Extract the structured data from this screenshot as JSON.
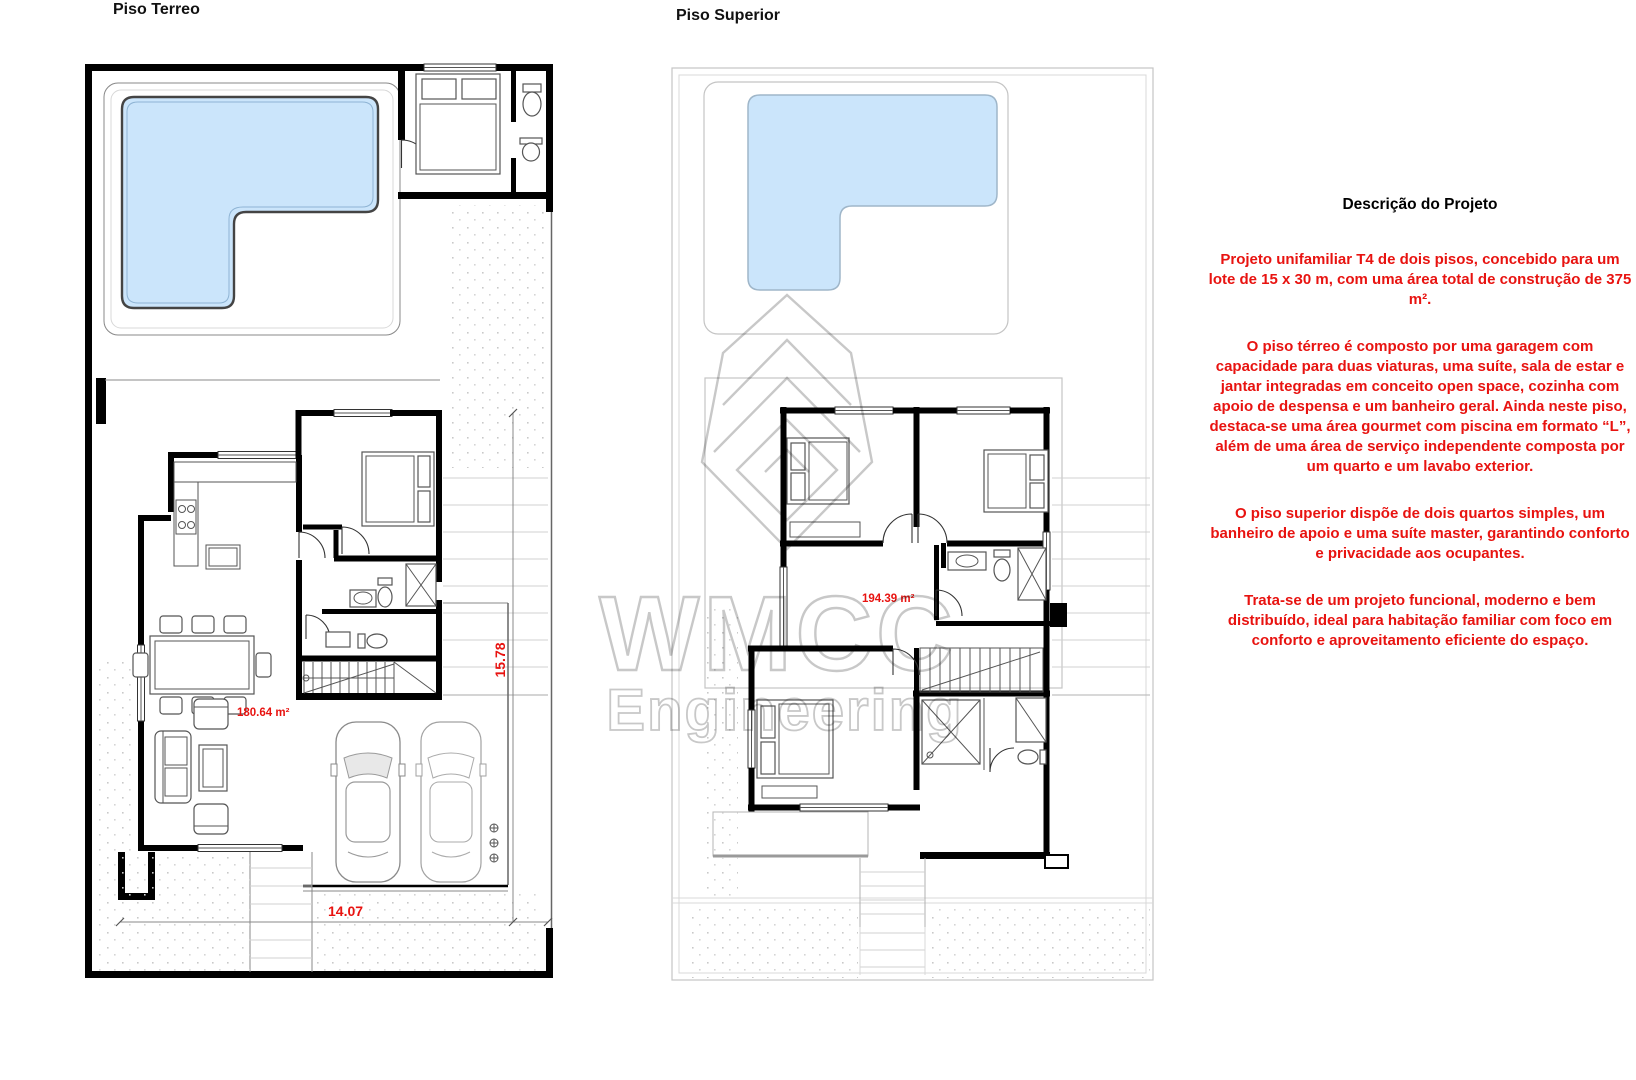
{
  "colors": {
    "red": "#e81310",
    "pool": "#cbe5fb",
    "wall": "#000000",
    "ghost": "#c4c4c4",
    "wm": "#a3a3a3"
  },
  "plans": {
    "ground": {
      "title": "Piso Terreo",
      "area_label": "180.64 m²",
      "dim_width": "14.07",
      "dim_height": "15.78"
    },
    "upper": {
      "title": "Piso Superior",
      "area_label": "194.39 m²"
    }
  },
  "watermark": {
    "line1": "WMCC",
    "line2": "Engineering"
  },
  "description": {
    "heading": "Descrição do Projeto",
    "paragraphs": [
      "Projeto unifamiliar T4 de dois pisos, concebido para um lote de 15 x 30 m, com uma área total de construção de 375 m².",
      "O piso térreo é composto por uma garagem com capacidade para duas viaturas, uma suíte, sala de estar e jantar integradas em conceito open space, cozinha com apoio de despensa e um banheiro geral. Ainda neste piso, destaca-se uma área gourmet com piscina em formato “L”, além de uma área de serviço independente composta por um quarto e um lavabo exterior.",
      "O piso superior dispõe de dois quartos simples, um banheiro de apoio e uma suíte master, garantindo conforto e privacidade aos ocupantes.",
      "Trata-se de um projeto funcional, moderno e bem distribuído, ideal para habitação familiar com foco em conforto e aproveitamento eficiente do espaço."
    ]
  }
}
